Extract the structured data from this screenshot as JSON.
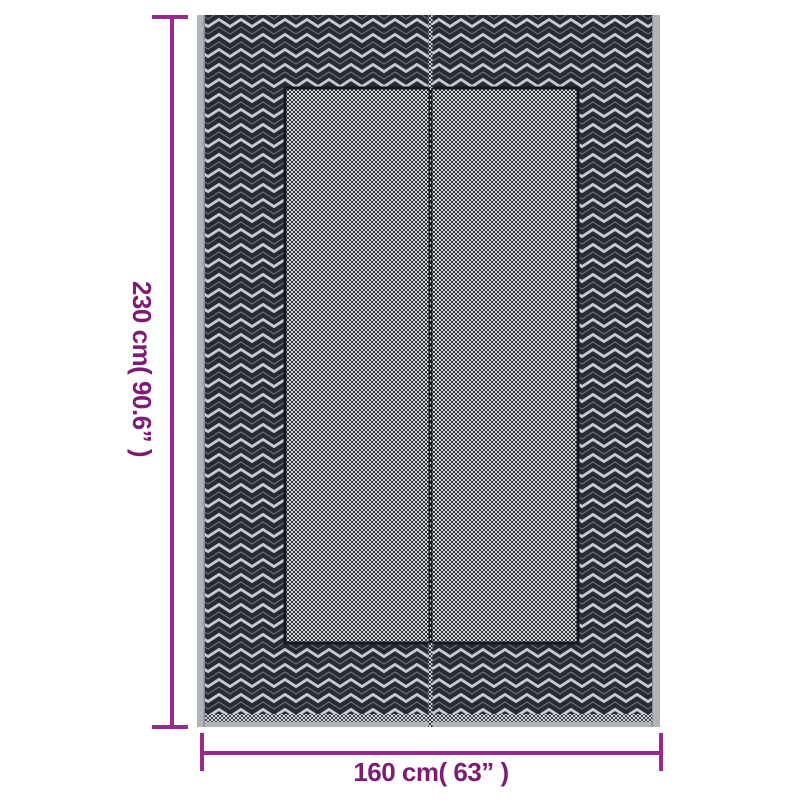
{
  "page": {
    "background": "#ffffff"
  },
  "rug": {
    "description_name": "chevron-outdoor-rug-photo",
    "colors": {
      "border_dark": "#262b34",
      "chevron_light": "#c7cbd1",
      "panel_light": "#d6d8dc",
      "panel_dark": "#2d3138",
      "edge_gray": "#b1b5ba",
      "panel_outline": "#14181f"
    }
  },
  "annotations": {
    "height_label": "230 cm( 90.6” )",
    "width_label": "160 cm( 63” )",
    "line_color": "#962a90",
    "text_color": "#7d1c75"
  }
}
